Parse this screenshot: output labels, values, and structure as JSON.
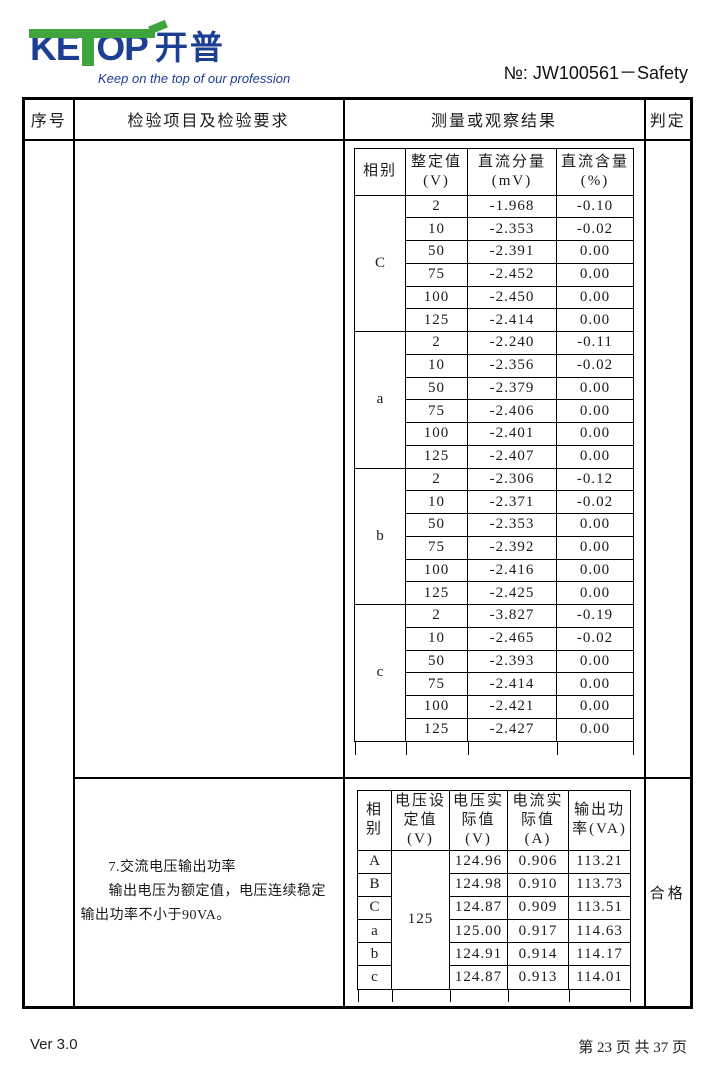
{
  "header": {
    "logo": {
      "ke": "KE",
      "op": "OP",
      "cn": "开普",
      "tagline": "Keep on the top of our profession",
      "brand_blue": "#1c3f94",
      "brand_green": "#3fa43c"
    },
    "doc_no": "№:  JW100561－Safety"
  },
  "outer_table": {
    "headers": [
      "序号",
      "检验项目及检验要求",
      "测量或观察结果",
      "判定"
    ]
  },
  "section1": {
    "table": {
      "headers": [
        [
          "相别"
        ],
        [
          "整定值",
          "(V)"
        ],
        [
          "直流分量",
          "(mV)"
        ],
        [
          "直流含量",
          "(%)"
        ]
      ],
      "groups": [
        {
          "phase": "C",
          "rows": [
            [
              "2",
              "-1.968",
              "-0.10"
            ],
            [
              "10",
              "-2.353",
              "-0.02"
            ],
            [
              "50",
              "-2.391",
              "0.00"
            ],
            [
              "75",
              "-2.452",
              "0.00"
            ],
            [
              "100",
              "-2.450",
              "0.00"
            ],
            [
              "125",
              "-2.414",
              "0.00"
            ]
          ]
        },
        {
          "phase": "a",
          "rows": [
            [
              "2",
              "-2.240",
              "-0.11"
            ],
            [
              "10",
              "-2.356",
              "-0.02"
            ],
            [
              "50",
              "-2.379",
              "0.00"
            ],
            [
              "75",
              "-2.406",
              "0.00"
            ],
            [
              "100",
              "-2.401",
              "0.00"
            ],
            [
              "125",
              "-2.407",
              "0.00"
            ]
          ]
        },
        {
          "phase": "b",
          "rows": [
            [
              "2",
              "-2.306",
              "-0.12"
            ],
            [
              "10",
              "-2.371",
              "-0.02"
            ],
            [
              "50",
              "-2.353",
              "0.00"
            ],
            [
              "75",
              "-2.392",
              "0.00"
            ],
            [
              "100",
              "-2.416",
              "0.00"
            ],
            [
              "125",
              "-2.425",
              "0.00"
            ]
          ]
        },
        {
          "phase": "c",
          "rows": [
            [
              "2",
              "-3.827",
              "-0.19"
            ],
            [
              "10",
              "-2.465",
              "-0.02"
            ],
            [
              "50",
              "-2.393",
              "0.00"
            ],
            [
              "75",
              "-2.414",
              "0.00"
            ],
            [
              "100",
              "-2.421",
              "0.00"
            ],
            [
              "125",
              "-2.427",
              "0.00"
            ]
          ]
        }
      ]
    }
  },
  "section2": {
    "requirement_title": "7.交流电压输出功率",
    "requirement_body": "输出电压为额定值，电压连续稳定输出功率不小于90VA。",
    "verdict": "合格",
    "table": {
      "headers": [
        [
          "相",
          "别"
        ],
        [
          "电压设",
          "定值",
          "(V)"
        ],
        [
          "电压实",
          "际值",
          "(V)"
        ],
        [
          "电流实",
          "际值",
          "(A)"
        ],
        [
          "输出功",
          "率(VA)"
        ]
      ],
      "voltage_setting": "125",
      "rows": [
        [
          "A",
          "124.96",
          "0.906",
          "113.21"
        ],
        [
          "B",
          "124.98",
          "0.910",
          "113.73"
        ],
        [
          "C",
          "124.87",
          "0.909",
          "113.51"
        ],
        [
          "a",
          "125.00",
          "0.917",
          "114.63"
        ],
        [
          "b",
          "124.91",
          "0.914",
          "114.17"
        ],
        [
          "c",
          "124.87",
          "0.913",
          "114.01"
        ]
      ]
    }
  },
  "footer": {
    "version": "Ver 3.0",
    "page_info": "第 23 页 共 37 页"
  }
}
